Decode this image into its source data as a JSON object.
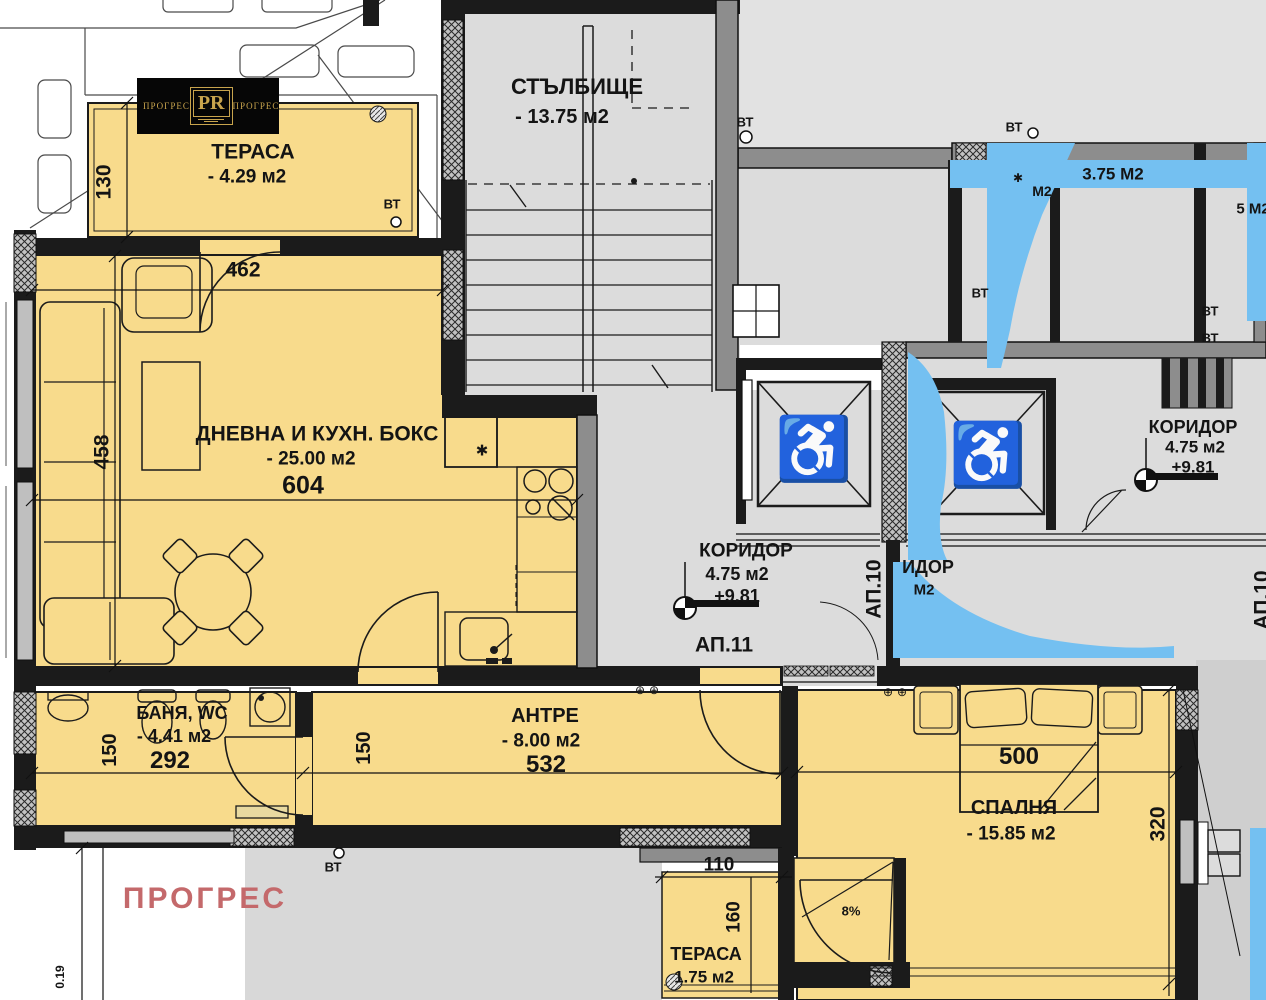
{
  "logo": {
    "brand": "ПРОГРЕС",
    "monogram": "PR"
  },
  "watermark": "ПРОГРЕС",
  "rooms": {
    "terrace_top": {
      "name": "ТЕРАСА",
      "area": "- 4.29 м2"
    },
    "staircase": {
      "name": "СТЪЛБИЩЕ",
      "area": "- 13.75 м2"
    },
    "living": {
      "name": "ДНЕВНА И КУХН. БОКС",
      "area": "- 25.00 м2"
    },
    "corridor_mid": {
      "name": "КОРИДОР",
      "area": "4.75 м2",
      "level": "+9.81"
    },
    "corridor_right": {
      "name": "КОРИДОР",
      "area": "4.75 м2",
      "level": "+9.81"
    },
    "bath": {
      "name": "БАНЯ, WC",
      "area": "- 4.41 м2"
    },
    "antre": {
      "name": "АНТРЕ",
      "area": "- 8.00 м2"
    },
    "bedroom": {
      "name": "СПАЛНЯ",
      "area": "- 15.85 м2"
    },
    "terrace_bottom": {
      "name": "ТЕРАСА",
      "area": "1.75 м2"
    }
  },
  "apartments": {
    "ap11": "АП.11",
    "ap10": "АП.10"
  },
  "dims": {
    "d130": "130",
    "d462": "462",
    "d604": "604",
    "d458": "458",
    "d292": "292",
    "d150": "150",
    "d532": "532",
    "d500": "500",
    "d320": "320",
    "d110": "110",
    "d160": "160",
    "d019": "0.19"
  },
  "annotations": {
    "vt": "ВТ",
    "slope": "8%"
  },
  "fragments": {
    "area_top": "3.75 М2",
    "m2": "М2",
    "m2_right": "5 М2",
    "coridor_partial": "ИДОР",
    "m2_mid": "М2"
  },
  "icons": {
    "wheelchair": "♿",
    "star": "✱",
    "pivot": "⊕"
  },
  "colors": {
    "room_fill": "#f8db8c",
    "common_fill": "#dcdcdc",
    "wall_dark": "#1b1b1b",
    "wall_gray": "#8d8d8d",
    "blue_overlay": "#74c0f1",
    "watermark": "#c4696b",
    "logo_gold": "#c8a44d",
    "logo_bg": "#060606"
  }
}
